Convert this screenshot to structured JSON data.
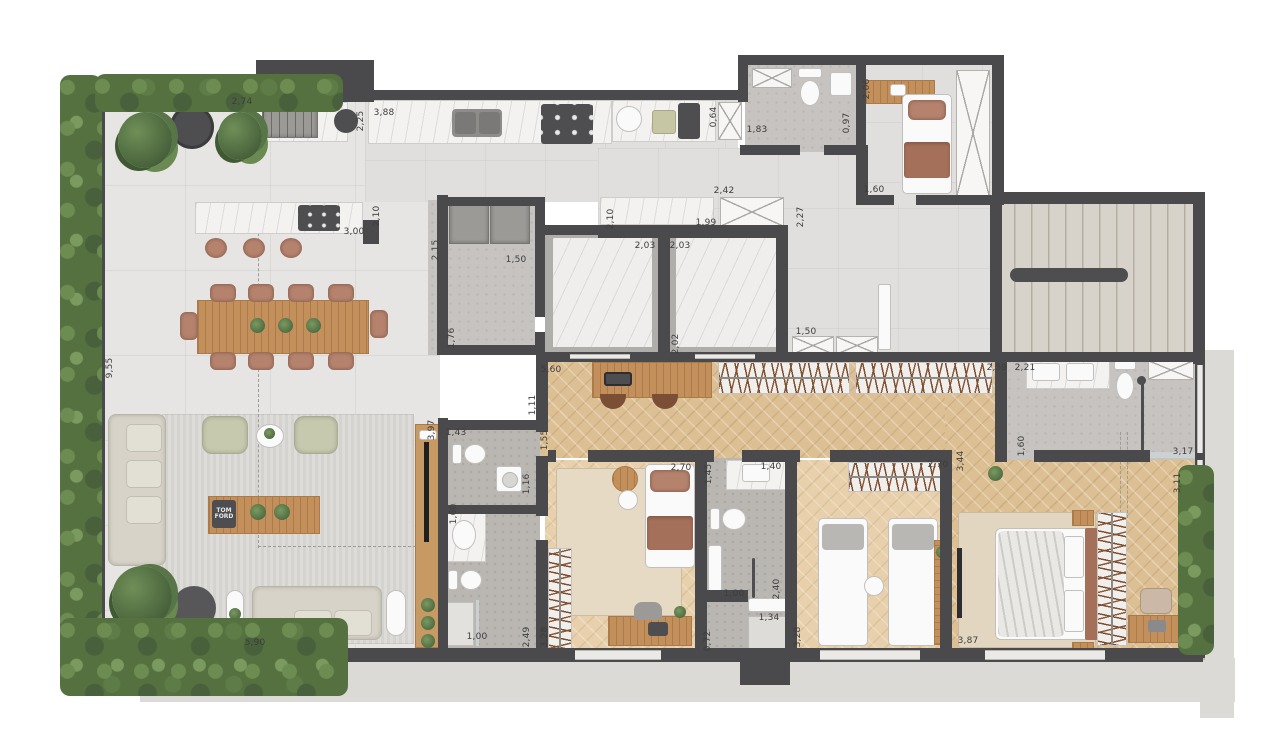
{
  "plan_title": "apartment-floor-plan",
  "colors": {
    "wall": "#4a4a4c",
    "terrace_tile": "#e6e5e3",
    "wood_floor": "#dcc094",
    "bedroom_wood": "#e7d0ab",
    "concrete": "#c6c3c0",
    "terracotta": "#b5826d",
    "sage": "#c6c9ae",
    "hedge_green": "#55713f",
    "furniture_wood": "#c3905c"
  },
  "book": {
    "line1": "TOM",
    "line2": "FORD"
  },
  "dimensions": [
    {
      "t": "2,74",
      "x": 242,
      "y": 102,
      "v": false
    },
    {
      "t": "2,25",
      "x": 361,
      "y": 121,
      "v": true
    },
    {
      "t": "3,88",
      "x": 384,
      "y": 113,
      "v": false
    },
    {
      "t": "3,00",
      "x": 354,
      "y": 232,
      "v": false
    },
    {
      "t": "2,10",
      "x": 377,
      "y": 216,
      "v": true
    },
    {
      "t": "2,15",
      "x": 436,
      "y": 250,
      "v": true
    },
    {
      "t": "1,50",
      "x": 516,
      "y": 260,
      "v": false
    },
    {
      "t": "1,76",
      "x": 452,
      "y": 338,
      "v": true
    },
    {
      "t": "2,10",
      "x": 611,
      "y": 219,
      "v": true
    },
    {
      "t": "1,99",
      "x": 706,
      "y": 223,
      "v": false
    },
    {
      "t": "2,42",
      "x": 724,
      "y": 191,
      "v": false
    },
    {
      "t": "0,64",
      "x": 714,
      "y": 117,
      "v": true
    },
    {
      "t": "1,83",
      "x": 757,
      "y": 130,
      "v": false
    },
    {
      "t": "0,97",
      "x": 847,
      "y": 123,
      "v": true
    },
    {
      "t": "2,06",
      "x": 867,
      "y": 89,
      "v": true
    },
    {
      "t": "1,60",
      "x": 874,
      "y": 190,
      "v": false
    },
    {
      "t": "2,27",
      "x": 801,
      "y": 217,
      "v": true
    },
    {
      "t": "2,03",
      "x": 645,
      "y": 246,
      "v": false
    },
    {
      "t": "2,03",
      "x": 680,
      "y": 246,
      "v": false
    },
    {
      "t": "2,02",
      "x": 676,
      "y": 344,
      "v": true
    },
    {
      "t": "1,50",
      "x": 806,
      "y": 332,
      "v": false
    },
    {
      "t": "2,59",
      "x": 997,
      "y": 368,
      "v": false
    },
    {
      "t": "2,21",
      "x": 1025,
      "y": 368,
      "v": false
    },
    {
      "t": "5,60",
      "x": 551,
      "y": 370,
      "v": false
    },
    {
      "t": "1,11",
      "x": 533,
      "y": 405,
      "v": true
    },
    {
      "t": "1,55",
      "x": 545,
      "y": 440,
      "v": true
    },
    {
      "t": "3,97",
      "x": 432,
      "y": 430,
      "v": true
    },
    {
      "t": "1,43",
      "x": 456,
      "y": 433,
      "v": false
    },
    {
      "t": "1,16",
      "x": 527,
      "y": 484,
      "v": true
    },
    {
      "t": "1,60",
      "x": 454,
      "y": 514,
      "v": true
    },
    {
      "t": "2,49",
      "x": 527,
      "y": 637,
      "v": true
    },
    {
      "t": "1,00",
      "x": 477,
      "y": 637,
      "v": false
    },
    {
      "t": "3,28",
      "x": 545,
      "y": 637,
      "v": true
    },
    {
      "t": "2,70",
      "x": 681,
      "y": 468,
      "v": false
    },
    {
      "t": "1,45",
      "x": 709,
      "y": 474,
      "v": true
    },
    {
      "t": "1,40",
      "x": 771,
      "y": 467,
      "v": false
    },
    {
      "t": "1,00",
      "x": 734,
      "y": 594,
      "v": false
    },
    {
      "t": "2,40",
      "x": 777,
      "y": 589,
      "v": true
    },
    {
      "t": "1,34",
      "x": 769,
      "y": 618,
      "v": false
    },
    {
      "t": "0,72",
      "x": 708,
      "y": 641,
      "v": true
    },
    {
      "t": "3,28",
      "x": 798,
      "y": 637,
      "v": true
    },
    {
      "t": "2,70",
      "x": 938,
      "y": 465,
      "v": false
    },
    {
      "t": "3,44",
      "x": 961,
      "y": 461,
      "v": true
    },
    {
      "t": "3,87",
      "x": 968,
      "y": 641,
      "v": false
    },
    {
      "t": "1,60",
      "x": 1022,
      "y": 446,
      "v": true
    },
    {
      "t": "3,17",
      "x": 1183,
      "y": 452,
      "v": false
    },
    {
      "t": "3,11",
      "x": 1178,
      "y": 483,
      "v": true
    },
    {
      "t": "9,55",
      "x": 110,
      "y": 368,
      "v": true
    },
    {
      "t": "5,90",
      "x": 255,
      "y": 643,
      "v": false
    }
  ]
}
